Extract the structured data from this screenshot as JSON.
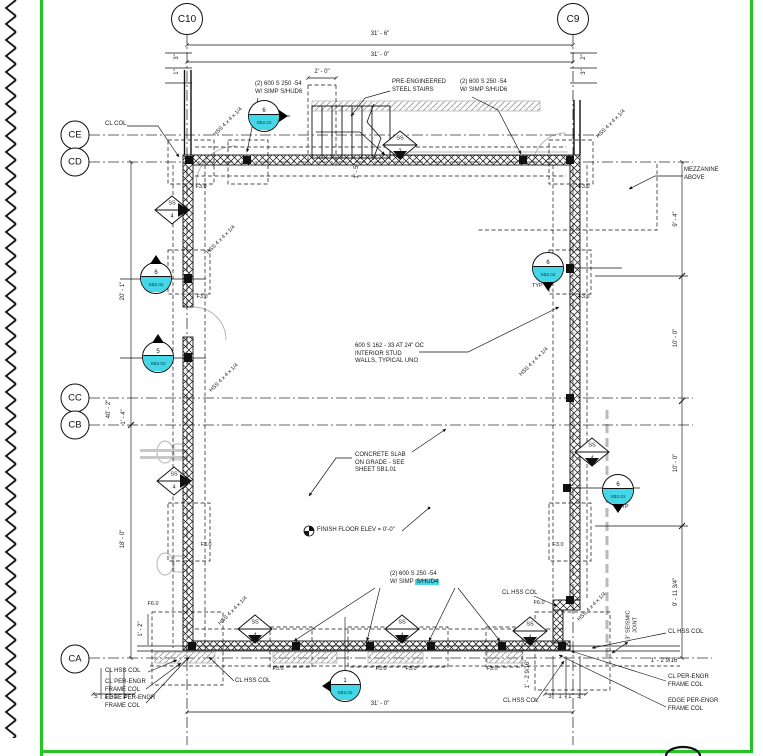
{
  "sheet": {
    "border_color": "#22c522",
    "highlight_color": "#43d7e8",
    "background": "#ffffff"
  },
  "grid": {
    "c10": "C10",
    "c9": "C9",
    "ce": "CE",
    "cd": "CD",
    "cc": "CC",
    "cb": "CB",
    "ca": "CA"
  },
  "dims": {
    "top_outer": "31' - 6\"",
    "top_inner": "31' - 0\"",
    "stair_landing": "2' - 0\"",
    "bottom": "31' - 0\"",
    "left_upper": "20' - 1\"",
    "left_lower": "18' - 0\"",
    "left_overall": "40' - 2\"",
    "left_small": "1' - 4\"",
    "right_1": "9' - 4\"",
    "right_2": "10' - 0\"",
    "right_3": "10' - 0\"",
    "right_4": "9' - 11 3/4\"",
    "tl_a": "3\"",
    "tl_b": "1\"",
    "tr_a": "2\"",
    "tr_b": "3\"",
    "stair_width": "1' - 5\"",
    "bl_a": "5\"",
    "bl_b": "1' - 1\"",
    "bl_c": "2\"",
    "bl_d": "1' - 2\"",
    "br_a": "3\"",
    "br_b": "1' - 1\"",
    "br_c": "3\"",
    "br_d": "1' - 2 9/16\"",
    "br_e": "1' - 2 9/16\""
  },
  "notes": {
    "stud_pack_l1": "(2) 600 S 250 -54",
    "stud_pack_tl_l2": "W/ SIMP S/HUD6",
    "stud_pack_tr_l2": "W/ SIMP S/HUD6",
    "stud_pack_bot_prefix": "W/ SIMP ",
    "stud_pack_bot_hl": "S/HUD4",
    "stairs_l1": "PRE-ENGINEERED",
    "stairs_l2": "STEEL STAIRS",
    "mezzanine_l1": "MEZZANINE",
    "mezzanine_l2": "ABOVE",
    "interior_l1": "600 S 162 - 33 AT 24\" OC",
    "interior_l2": "INTERIOR STUD",
    "interior_l3": "WALLS, TYPICAL UNO",
    "slab_l1": "CONCRETE SLAB",
    "slab_l2": "ON GRADE - SEE",
    "slab_l3": "SHEET SB1.01",
    "ffe": "FINISH FLOOR ELEV = 0'-0\"",
    "cl_col": "CL COL",
    "cl_hss_col": "CL HSS COL",
    "cl_per_engr_l1": "CL PER-ENGR",
    "cl_per_engr_l2": "FRAME COL",
    "edge_per_engr_l1": "EDGE PER-ENGR",
    "edge_per_engr_l2": "FRAME COL",
    "seismic_l1": "3\" SEISMIC",
    "seismic_l2": "JOINT",
    "typ": "TYP",
    "hss_col": "HSS 4 x 4 x 1/4",
    "f30": "F3.0",
    "f60": "F6.0"
  },
  "callouts": {
    "ss": "SS",
    "ss_2": "2",
    "ss_4": "4",
    "sec_sheet": "SB2.02",
    "sec_6": "6",
    "sec_5": "5",
    "sec_1": "1"
  }
}
